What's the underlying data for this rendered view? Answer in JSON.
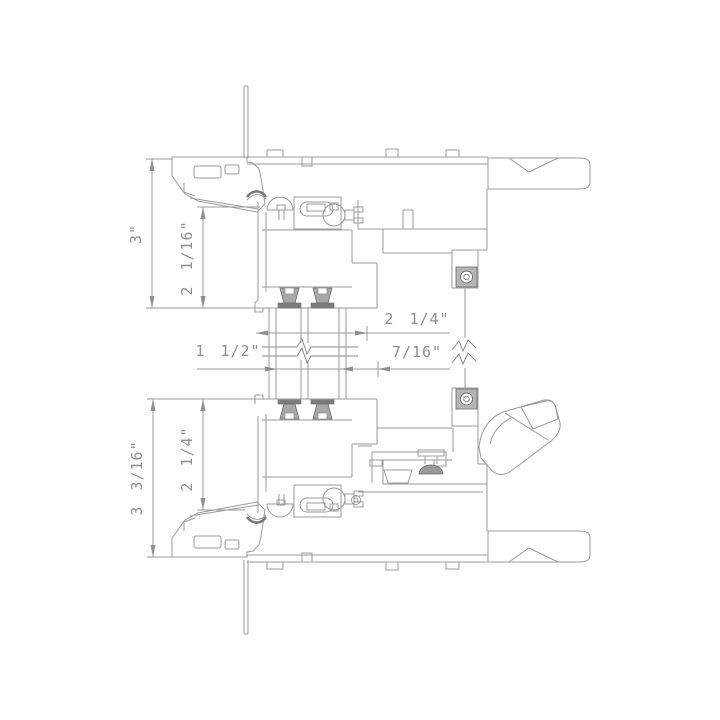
{
  "drawing": {
    "title": "window-frame-section-detail",
    "units": "inches",
    "colors": {
      "line": "#9b9b9b",
      "dark": "#6b6b6b",
      "fill_medium": "#a8a8a8",
      "fill_dark": "#7d7d7d",
      "text": "#8f8f8f",
      "background": "#ffffff"
    },
    "dimensions": {
      "top_frame_height": "3\"",
      "top_sash_height": "2 1/16\"",
      "sash_depth": "2 1/4\"",
      "glazing_thickness": "1 1/2\"",
      "reveal_offset": "7/16\"",
      "bottom_frame_height": "3 3/16\"",
      "bottom_sash_height": "2 1/4\""
    }
  }
}
